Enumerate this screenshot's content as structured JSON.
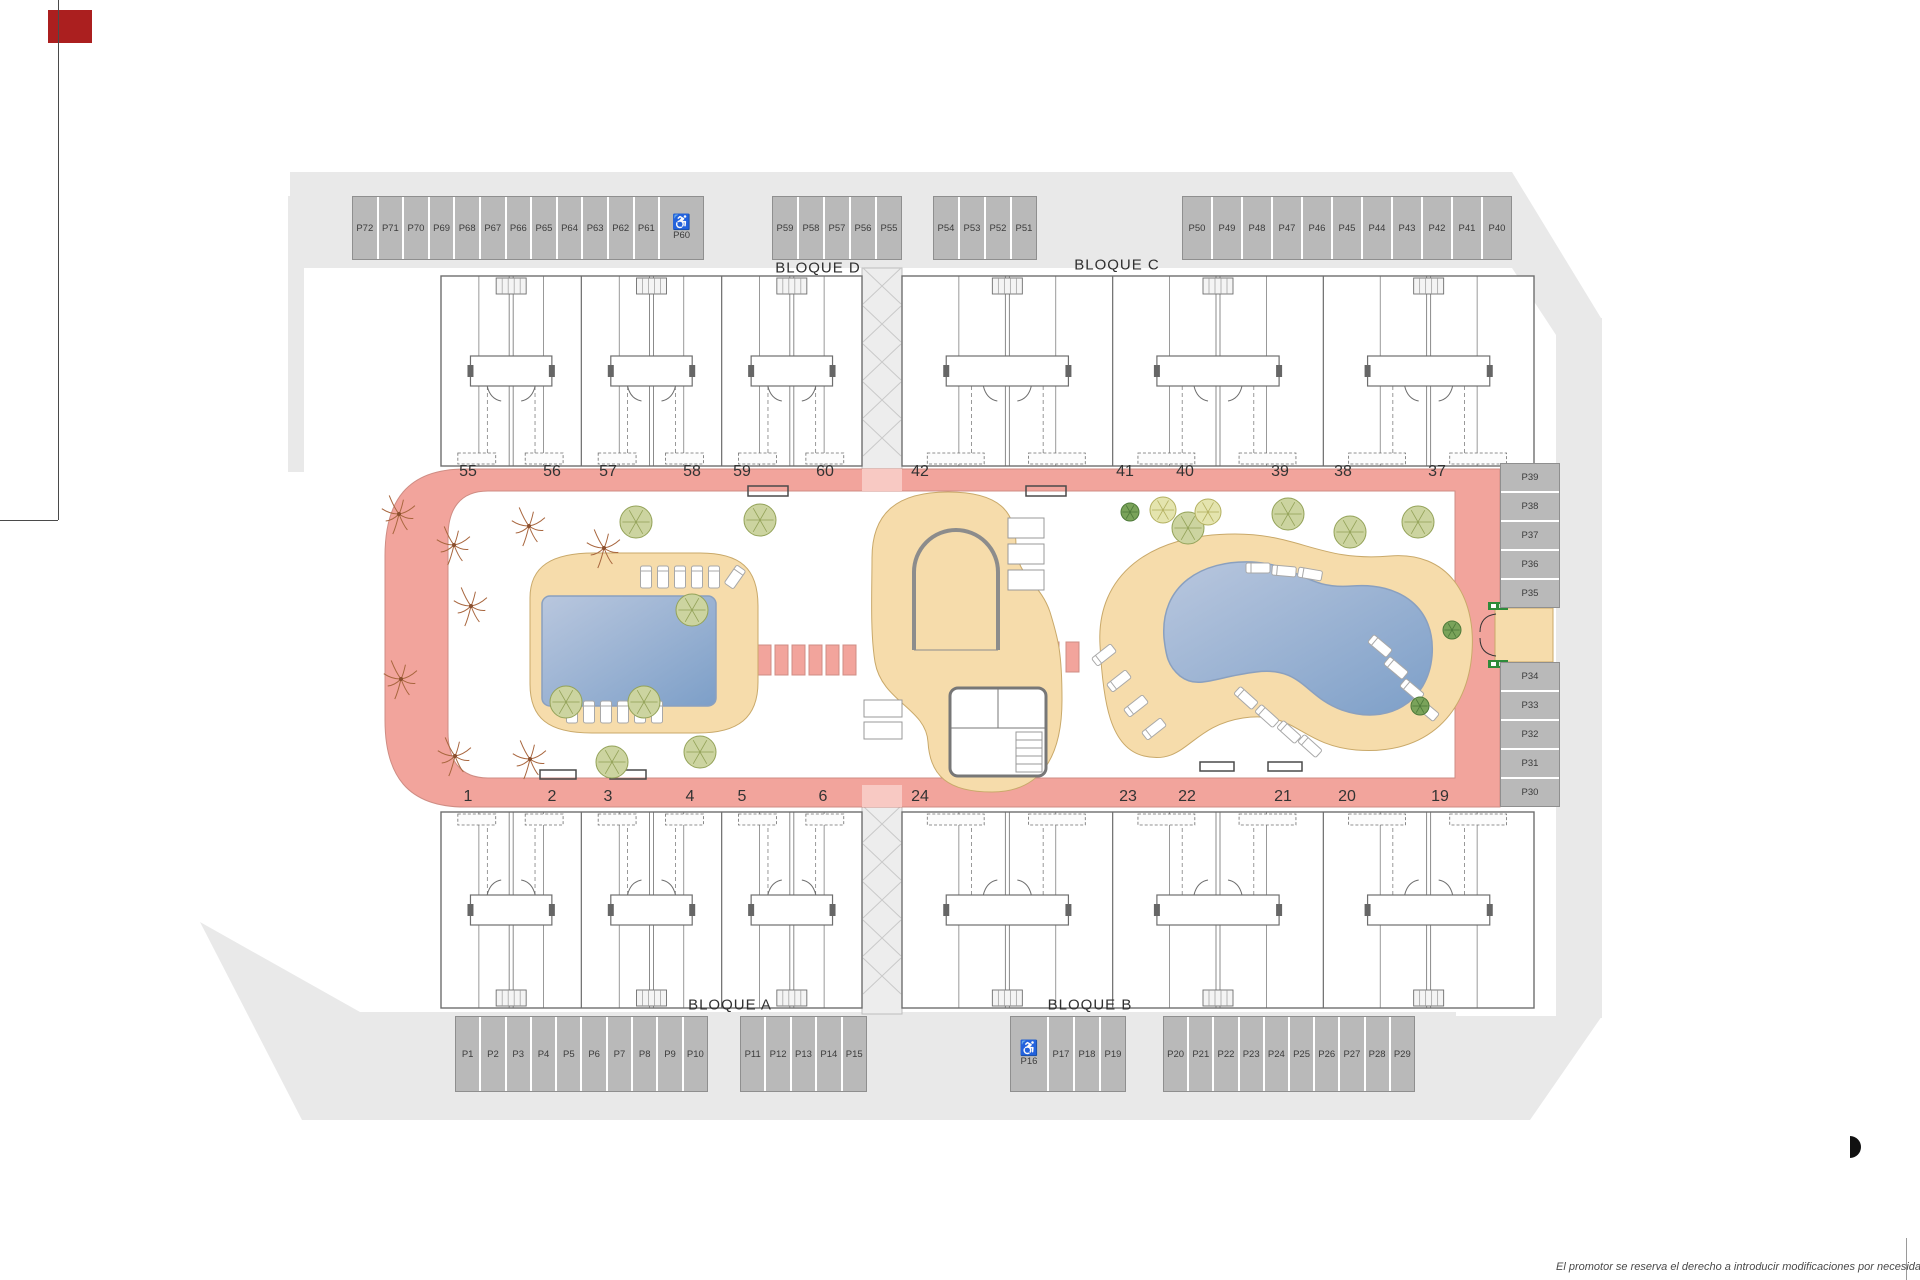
{
  "labels": {
    "bloque_a": "BLOQUE A",
    "bloque_b": "BLOQUE B",
    "bloque_c": "BLOQUE C",
    "bloque_d": "BLOQUE D"
  },
  "disclaimer": "El promotor se reserva el derecho a introducir modificaciones por necesidad de índole técnica o legal",
  "accessible_icon": "♿",
  "colors": {
    "road": "#e9e9e9",
    "stall": "#b9b9b9",
    "walkway_pink": "#f2a49c",
    "deck_tan": "#f6dcab",
    "pool_blue": "#7fa3cc",
    "marker_red": "#ab1f1f",
    "exit_sign_green": "#2e8b3a"
  },
  "parking": {
    "groups": [
      {
        "id": "top-left",
        "dir": "h",
        "x": 352,
        "y": 196,
        "stall_w": 23.6,
        "stall_h": 62,
        "stalls": [
          {
            "label": "P72"
          },
          {
            "label": "P71"
          },
          {
            "label": "P70"
          },
          {
            "label": "P69"
          },
          {
            "label": "P68"
          },
          {
            "label": "P67"
          },
          {
            "label": "P66"
          },
          {
            "label": "P65"
          },
          {
            "label": "P64"
          },
          {
            "label": "P63"
          },
          {
            "label": "P62"
          },
          {
            "label": "P61"
          },
          {
            "label": "P60",
            "accessible": true,
            "w": 43
          }
        ]
      },
      {
        "id": "top-mid-1",
        "dir": "h",
        "x": 772,
        "y": 196,
        "stall_w": 24,
        "stall_h": 62,
        "stalls": [
          {
            "label": "P59"
          },
          {
            "label": "P58"
          },
          {
            "label": "P57"
          },
          {
            "label": "P56"
          },
          {
            "label": "P55"
          }
        ]
      },
      {
        "id": "top-mid-2",
        "dir": "h",
        "x": 933,
        "y": 196,
        "stall_w": 24,
        "stall_h": 62,
        "stalls": [
          {
            "label": "P54"
          },
          {
            "label": "P53"
          },
          {
            "label": "P52"
          },
          {
            "label": "P51"
          }
        ]
      },
      {
        "id": "top-right",
        "dir": "h",
        "x": 1182,
        "y": 196,
        "stall_w": 28,
        "stall_h": 62,
        "stalls": [
          {
            "label": "P50"
          },
          {
            "label": "P49"
          },
          {
            "label": "P48"
          },
          {
            "label": "P47"
          },
          {
            "label": "P46"
          },
          {
            "label": "P45"
          },
          {
            "label": "P44"
          },
          {
            "label": "P43"
          },
          {
            "label": "P42"
          },
          {
            "label": "P41"
          },
          {
            "label": "P40"
          }
        ]
      },
      {
        "id": "right-upper",
        "dir": "v",
        "x": 1500,
        "y": 463,
        "stall_w": 58,
        "stall_h": 27,
        "stalls": [
          {
            "label": "P39"
          },
          {
            "label": "P38"
          },
          {
            "label": "P37"
          },
          {
            "label": "P36"
          },
          {
            "label": "P35"
          }
        ]
      },
      {
        "id": "right-lower",
        "dir": "v",
        "x": 1500,
        "y": 662,
        "stall_w": 58,
        "stall_h": 27,
        "stalls": [
          {
            "label": "P34"
          },
          {
            "label": "P33"
          },
          {
            "label": "P32"
          },
          {
            "label": "P31"
          },
          {
            "label": "P30"
          }
        ]
      },
      {
        "id": "bottom-left",
        "dir": "h",
        "x": 455,
        "y": 1016,
        "stall_w": 23.3,
        "stall_h": 74,
        "stalls": [
          {
            "label": "P1"
          },
          {
            "label": "P2"
          },
          {
            "label": "P3"
          },
          {
            "label": "P4"
          },
          {
            "label": "P5"
          },
          {
            "label": "P6"
          },
          {
            "label": "P7"
          },
          {
            "label": "P8"
          },
          {
            "label": "P9"
          },
          {
            "label": "P10"
          }
        ]
      },
      {
        "id": "bottom-mid-1",
        "dir": "h",
        "x": 740,
        "y": 1016,
        "stall_w": 23.4,
        "stall_h": 74,
        "stalls": [
          {
            "label": "P11"
          },
          {
            "label": "P12"
          },
          {
            "label": "P13"
          },
          {
            "label": "P14"
          },
          {
            "label": "P15"
          }
        ]
      },
      {
        "id": "bottom-mid-2",
        "dir": "h",
        "x": 1010,
        "y": 1016,
        "stall_w": 24,
        "stall_h": 74,
        "stalls": [
          {
            "label": "P16",
            "accessible": true,
            "w": 36
          },
          {
            "label": "P17"
          },
          {
            "label": "P18"
          },
          {
            "label": "P19"
          }
        ]
      },
      {
        "id": "bottom-right",
        "dir": "h",
        "x": 1163,
        "y": 1016,
        "stall_w": 23.2,
        "stall_h": 74,
        "stalls": [
          {
            "label": "P20"
          },
          {
            "label": "P21"
          },
          {
            "label": "P22"
          },
          {
            "label": "P23"
          },
          {
            "label": "P24"
          },
          {
            "label": "P25"
          },
          {
            "label": "P26"
          },
          {
            "label": "P27"
          },
          {
            "label": "P28"
          },
          {
            "label": "P29"
          }
        ]
      }
    ]
  },
  "unit_numbers": {
    "top": {
      "y": 472,
      "items": [
        {
          "n": "55",
          "x": 468
        },
        {
          "n": "56",
          "x": 552
        },
        {
          "n": "57",
          "x": 608
        },
        {
          "n": "58",
          "x": 692
        },
        {
          "n": "59",
          "x": 742
        },
        {
          "n": "60",
          "x": 825
        },
        {
          "n": "42",
          "x": 920
        },
        {
          "n": "41",
          "x": 1125
        },
        {
          "n": "40",
          "x": 1185
        },
        {
          "n": "39",
          "x": 1280
        },
        {
          "n": "38",
          "x": 1343
        },
        {
          "n": "37",
          "x": 1437
        }
      ]
    },
    "bottom": {
      "y": 797,
      "items": [
        {
          "n": "1",
          "x": 468
        },
        {
          "n": "2",
          "x": 552
        },
        {
          "n": "3",
          "x": 608
        },
        {
          "n": "4",
          "x": 690
        },
        {
          "n": "5",
          "x": 742
        },
        {
          "n": "6",
          "x": 823
        },
        {
          "n": "24",
          "x": 920
        },
        {
          "n": "23",
          "x": 1128
        },
        {
          "n": "22",
          "x": 1187
        },
        {
          "n": "21",
          "x": 1283
        },
        {
          "n": "20",
          "x": 1347
        },
        {
          "n": "19",
          "x": 1440
        }
      ]
    }
  }
}
